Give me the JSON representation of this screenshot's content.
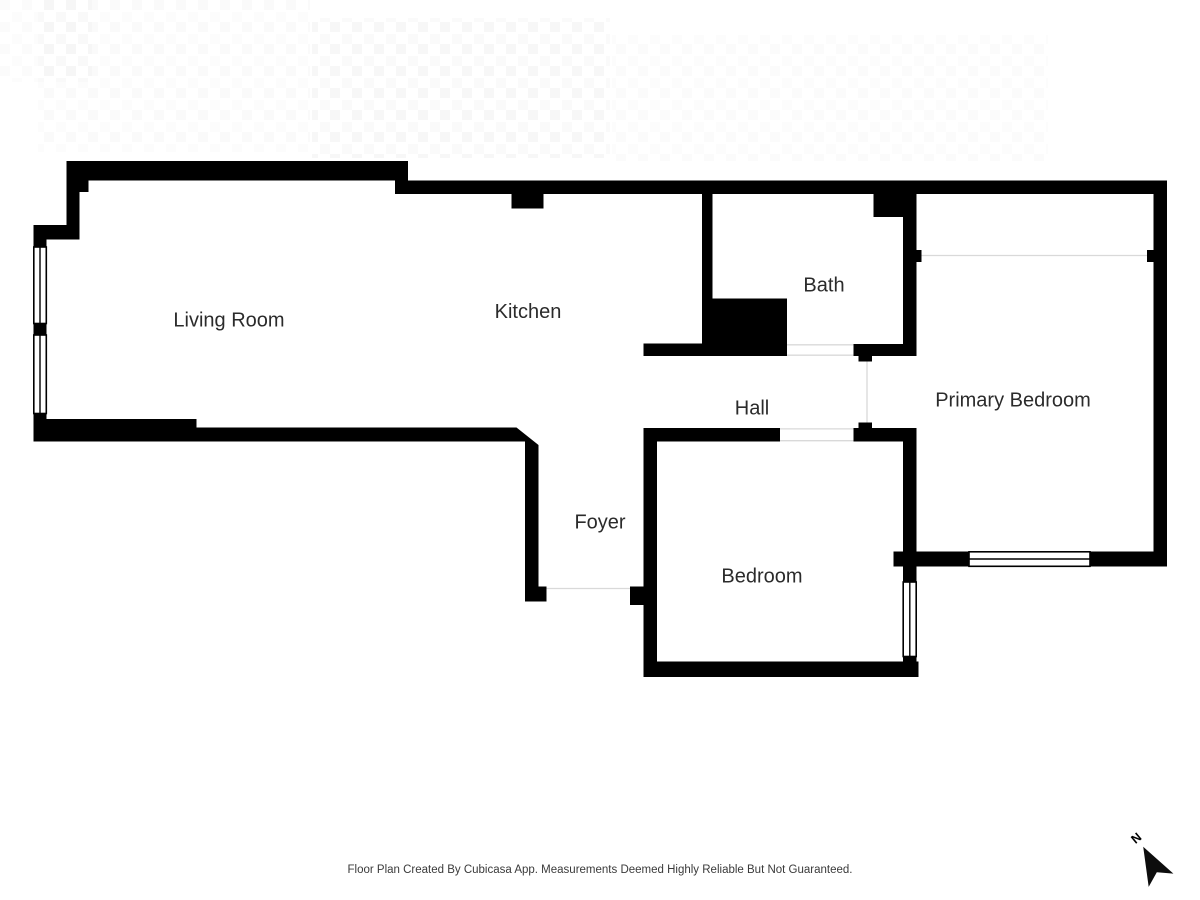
{
  "rooms": [
    {
      "id": "living-room",
      "label": "Living Room"
    },
    {
      "id": "kitchen",
      "label": "Kitchen"
    },
    {
      "id": "bath",
      "label": "Bath"
    },
    {
      "id": "hall",
      "label": "Hall"
    },
    {
      "id": "primary-bedroom",
      "label": "Primary Bedroom"
    },
    {
      "id": "foyer",
      "label": "Foyer"
    },
    {
      "id": "bedroom",
      "label": "Bedroom"
    }
  ],
  "compass": {
    "label": "N"
  },
  "footer": {
    "disclaimer": "Floor Plan Created By Cubicasa App. Measurements Deemed Highly Reliable But Not Guaranteed."
  },
  "colors": {
    "wall": "#000000",
    "background": "#ffffff",
    "room_text": "#2b2b2b",
    "footer_text": "#3a3a3a",
    "opening_line": "#d9d9d9",
    "faint_line": "#e6e6e6"
  }
}
